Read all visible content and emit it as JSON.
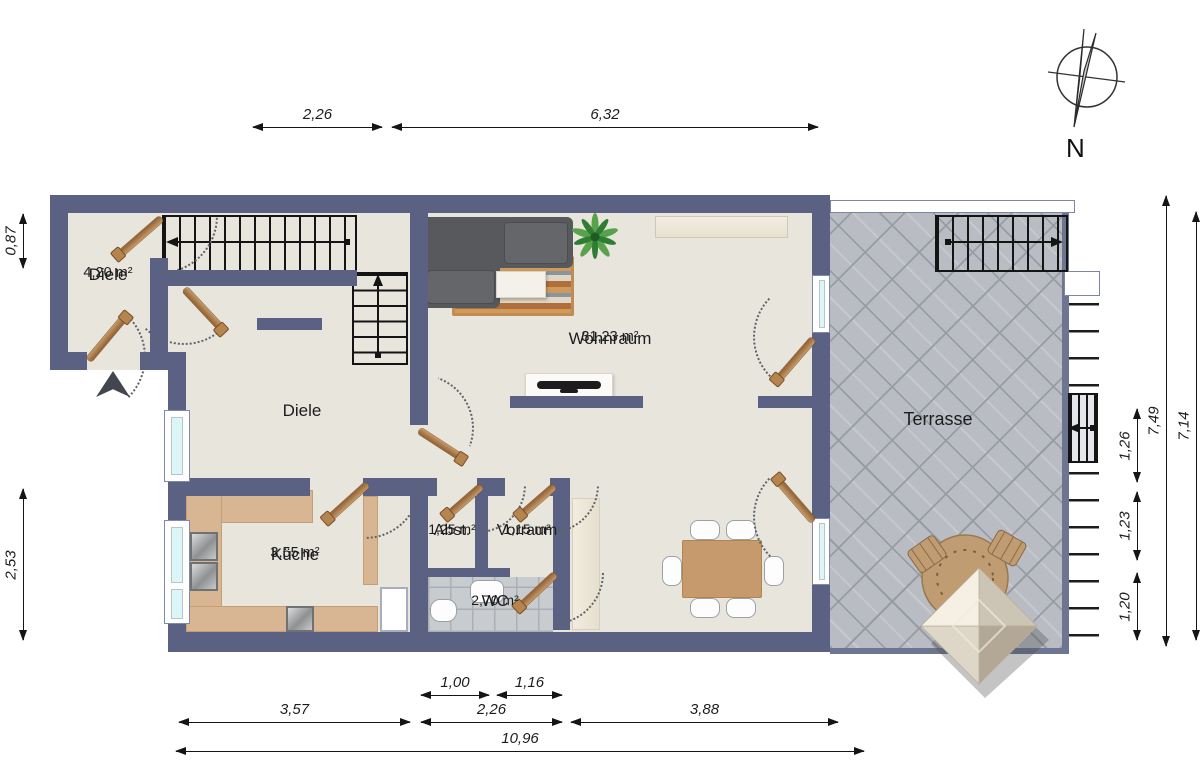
{
  "compass": {
    "north_label": "N"
  },
  "rooms": {
    "diele_entry": {
      "name": "Diele",
      "area": "4,20 m²"
    },
    "diele": {
      "name": "Diele"
    },
    "wohnraum": {
      "name": "Wohnraum",
      "area": "31,23 m²"
    },
    "kueche": {
      "name": "Küche",
      "area": "3,55 m²"
    },
    "abstellraum": {
      "name": "Abst.",
      "area": "1,25 m²"
    },
    "vorraum": {
      "name": "Vorraum",
      "area": "1,15 m²"
    },
    "wc": {
      "name": "WC",
      "area": "2,70 m²"
    },
    "terrasse": {
      "name": "Terrasse"
    }
  },
  "dimensions": {
    "top": {
      "d1": "2,26",
      "d2": "6,32"
    },
    "bottom": {
      "s1": "1,00",
      "s2": "1,16",
      "m1": "3,57",
      "m2": "2,26",
      "m3": "3,88",
      "total": "10,96"
    },
    "left": {
      "d1": "0,87",
      "d2": "2,53"
    },
    "right": {
      "outer": "7,49",
      "inner": "7,14",
      "s1": "1,26",
      "s2": "1,23",
      "s3": "1,20"
    }
  },
  "colors": {
    "wall": "#5a6183",
    "floor": "#e8e5dc",
    "counter": "#d8b593",
    "terrace_tile": "#b9bdc3",
    "wc_tile": "#c9cccf",
    "window_glass": "#dcf5f7",
    "door_wood": "#8f5f33",
    "dim_line": "#151515",
    "label_text": "#1d1d1f"
  }
}
